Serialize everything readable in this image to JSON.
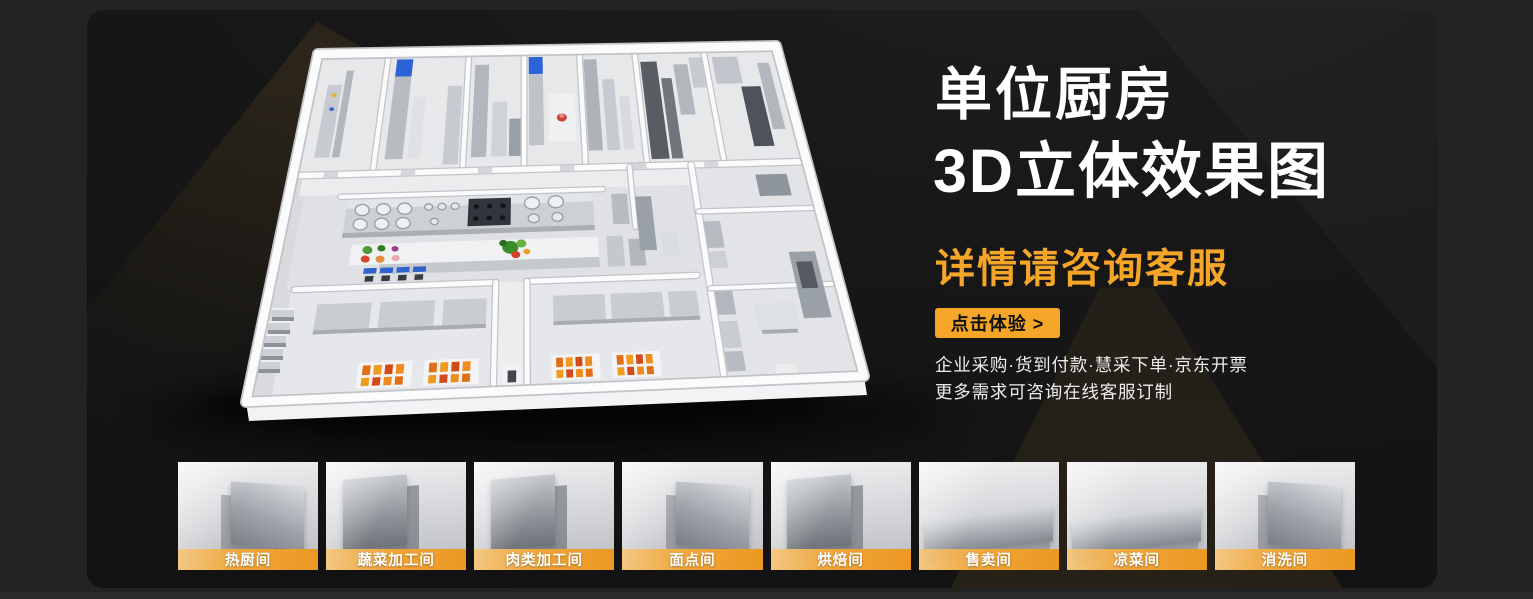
{
  "hero": {
    "title_line1": "单位厨房",
    "title_line2": "3D立体效果图",
    "subtitle": "详情请咨询客服",
    "cta_label": "点击体验 >",
    "benefits_line1": "企业采购·货到付款·慧采下单·京东开票",
    "benefits_line2": "更多需求可咨询在线客服订制"
  },
  "floorplan": {
    "description": "3D立体俯视效果图：单位厨房平面布局渲染（白色墙体、不锈钢厨具、灶台、备餐台、售餐间等）"
  },
  "thumbnails": [
    {
      "label": "热厨间"
    },
    {
      "label": "蔬菜加工间"
    },
    {
      "label": "肉类加工间"
    },
    {
      "label": "面点间"
    },
    {
      "label": "烘焙间"
    },
    {
      "label": "售卖间"
    },
    {
      "label": "凉菜间"
    },
    {
      "label": "消洗间"
    }
  ],
  "colors": {
    "accent_orange": "#F5A527",
    "label_gradient_start": "#F7C77C",
    "label_gradient_end": "#EC9722",
    "panel_bg": "#151516",
    "outer_bg": "#232324",
    "title_text": "#FFFFFF",
    "body_text": "#ECECEC"
  }
}
